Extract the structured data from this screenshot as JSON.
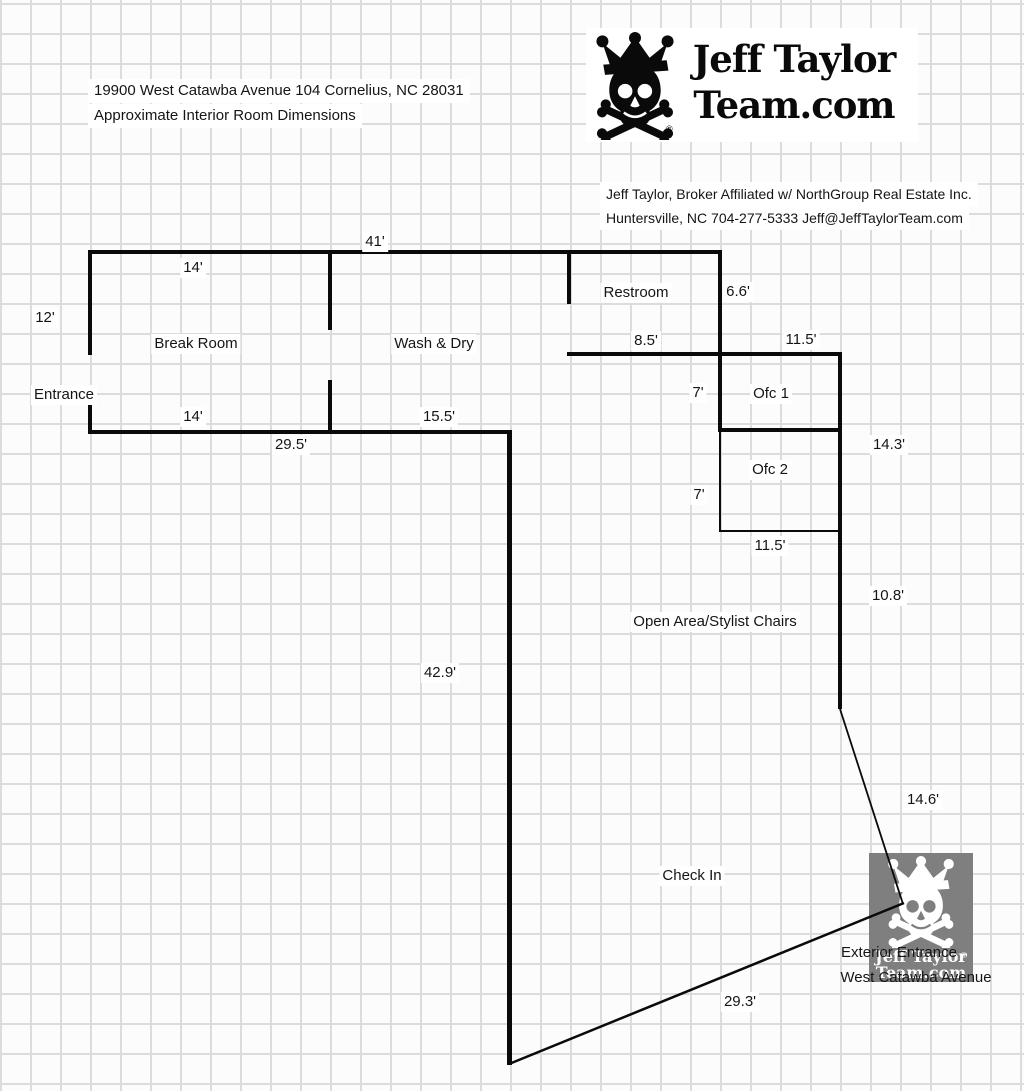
{
  "header": {
    "address": "19900 West Catawba Avenue 104 Cornelius, NC 28031",
    "subtitle": "Approximate Interior Room Dimensions"
  },
  "logo": {
    "team_line1": "Jeff Taylor",
    "team_line2": "Team.com",
    "registered": "®"
  },
  "broker": {
    "line1": "Jeff Taylor, Broker Affiliated w/ NorthGroup Real Estate Inc.",
    "line2": "Huntersville, NC 704-277-5333 Jeff@JeffTaylorTeam.com"
  },
  "plan": {
    "entrance_label": "Entrance",
    "rooms": {
      "break_room": "Break Room",
      "wash_dry": "Wash & Dry",
      "restroom": "Restroom",
      "ofc1": "Ofc 1",
      "ofc2": "Ofc 2",
      "open_area": "Open Area/Stylist Chairs",
      "check_in": "Check In"
    },
    "dimensions": {
      "top_width": "41'",
      "break_top": "14'",
      "left_height": "12'",
      "break_bottom": "14'",
      "wash_bottom": "15.5'",
      "front_width": "29.5'",
      "restroom_width": "8.5'",
      "restroom_height": "6.6'",
      "ofc1_width": "11.5'",
      "ofc1_height": "7'",
      "ofc2_width": "11.5'",
      "ofc2_height": "7'",
      "right_upper": "14.3'",
      "right_lower": "10.8'",
      "left_wall": "42.9'",
      "entry_diagonal": "14.6'",
      "front_diagonal": "29.3'"
    }
  },
  "exterior": {
    "line1": "Exterior Entrance",
    "line2": "West Catawba Avenue"
  },
  "watermark": {
    "line1": "Jeff Taylor",
    "line2": "Team.com",
    "registered": "®"
  },
  "colors": {
    "wall": "#0a0a0a",
    "grid_line": "#dcdcdc",
    "paper": "#fcfcfc",
    "watermark_gray": "#7f7f7f",
    "text": "#151515"
  }
}
